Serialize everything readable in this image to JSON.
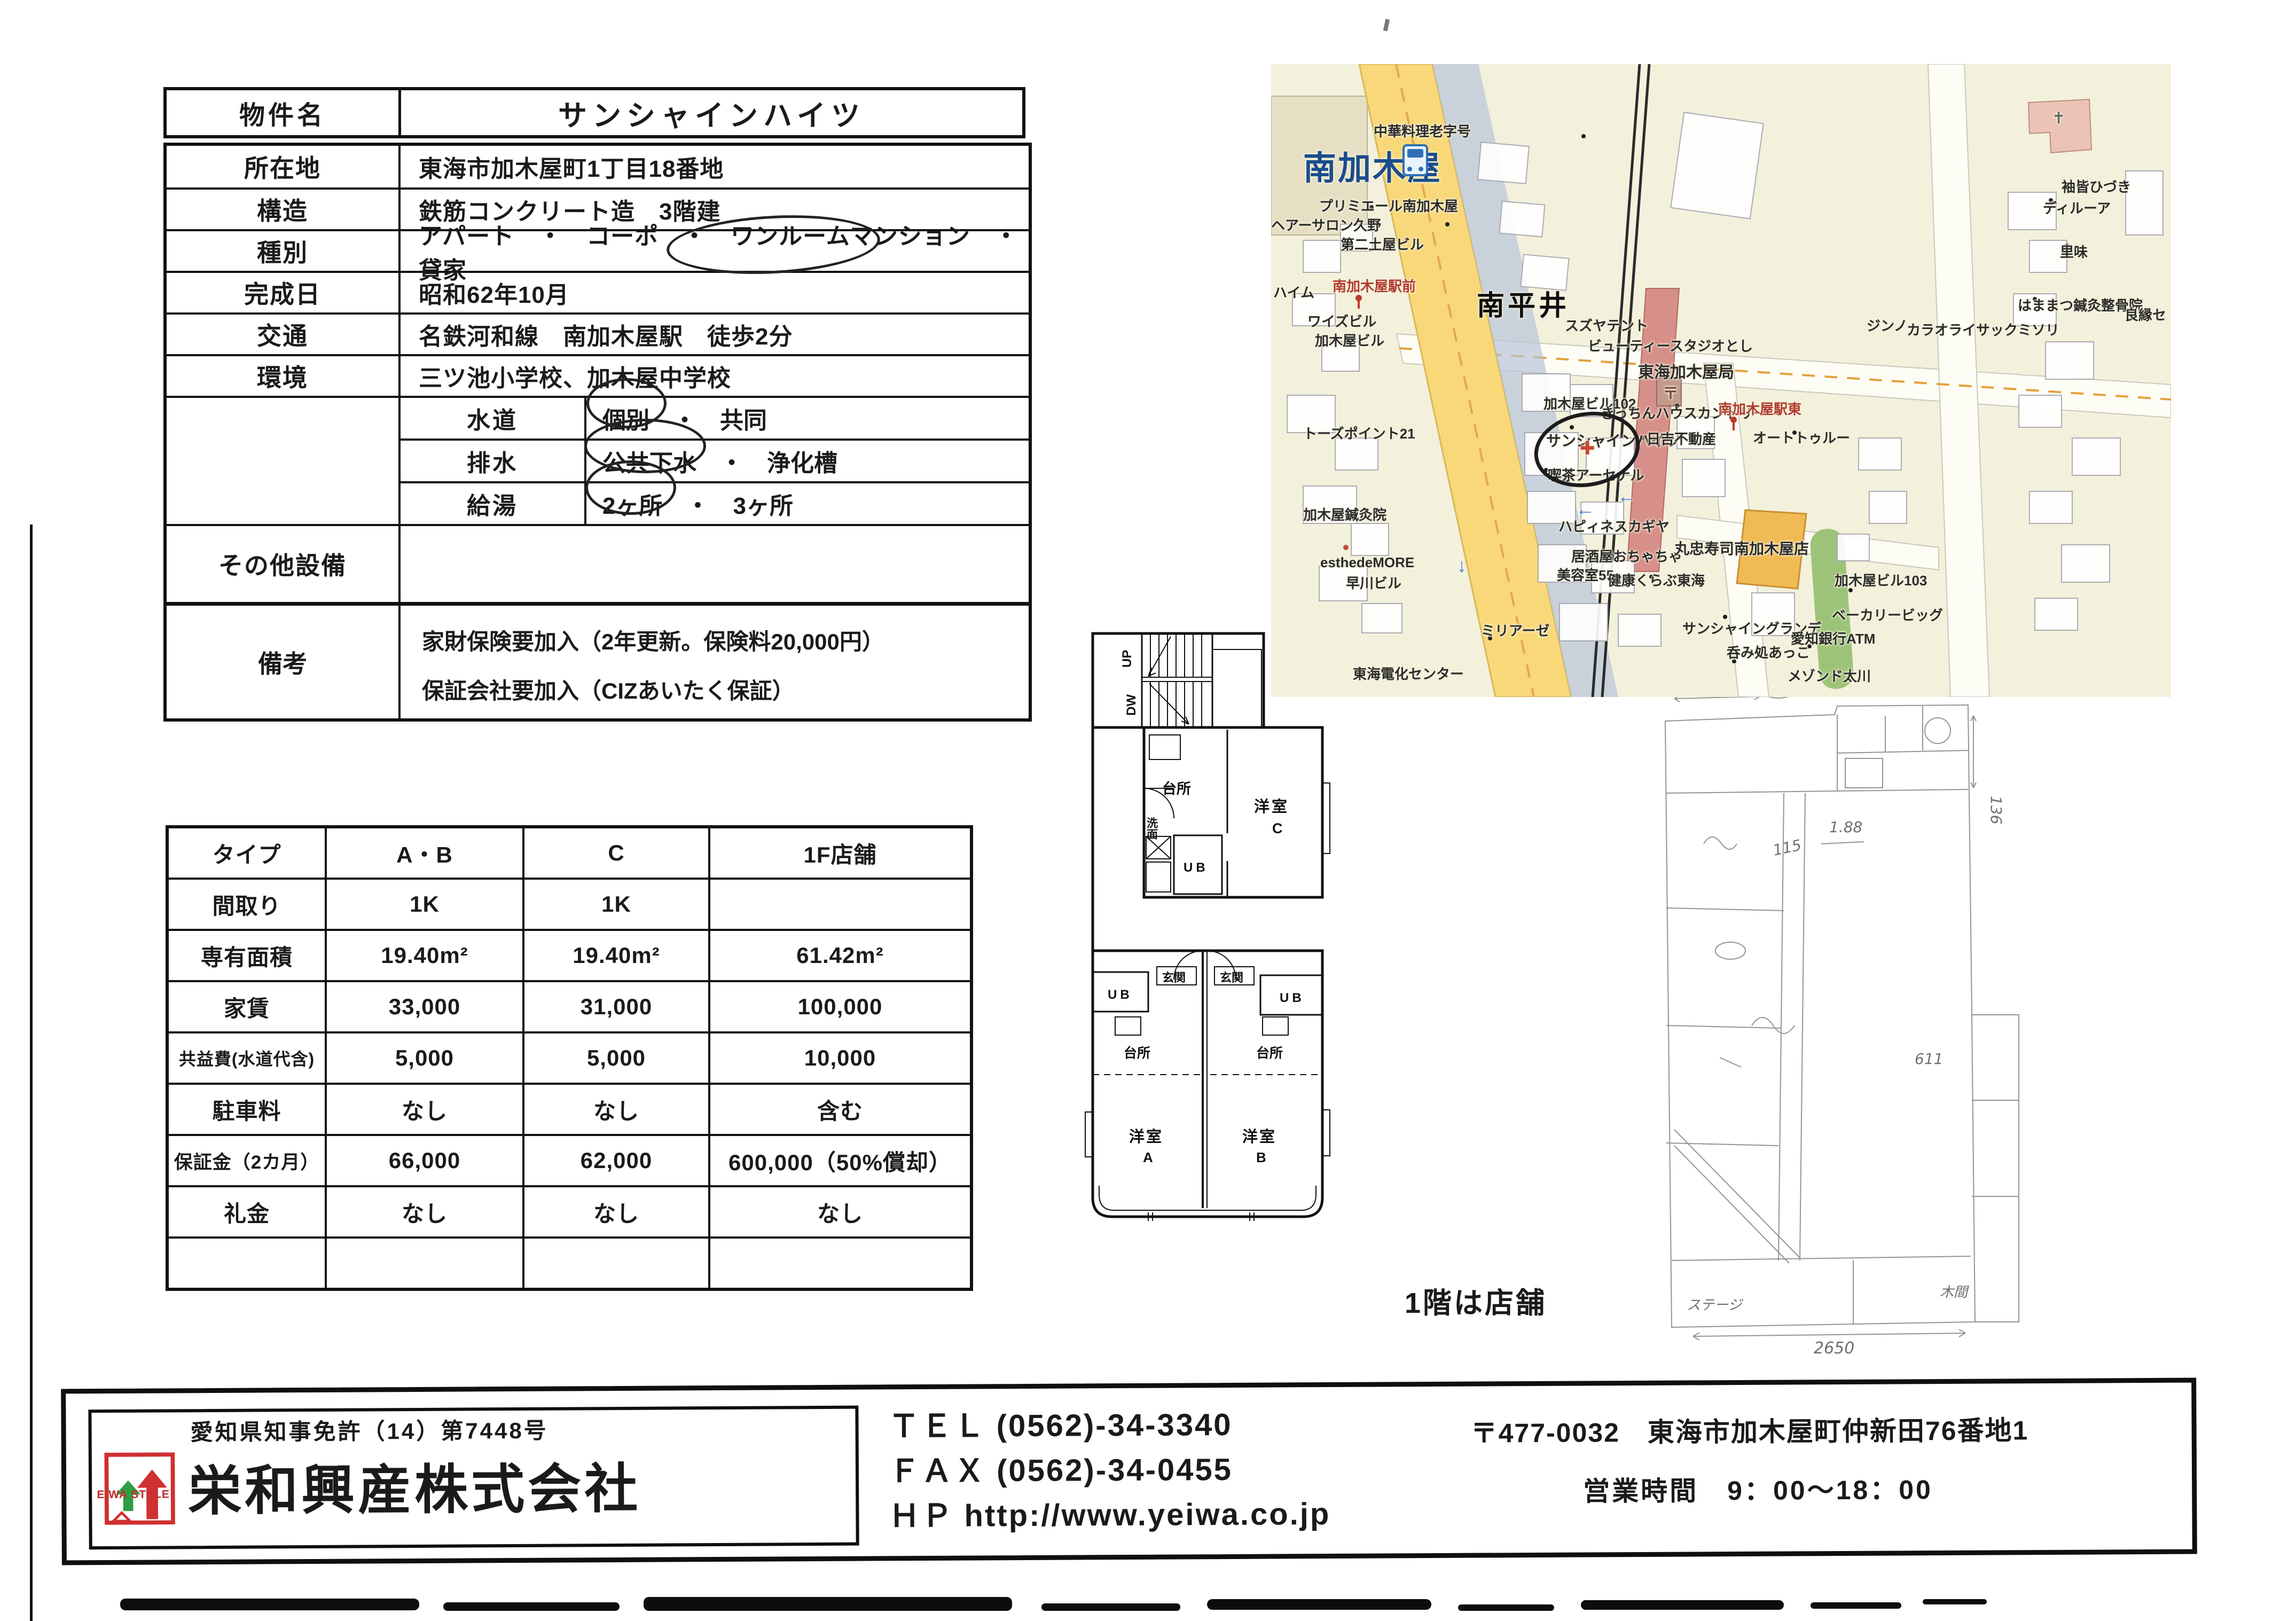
{
  "property": {
    "title_label": "物件名",
    "title": "サンシャインハイツ",
    "rows": [
      {
        "label": "所在地",
        "value": "東海市加木屋町1丁目18番地"
      },
      {
        "label": "構造",
        "value": "鉄筋コンクリート造　3階建"
      },
      {
        "label": "種別",
        "value": "アパート　・　コーポ　・　ワンルームマンション　・　貸家"
      },
      {
        "label": "完成日",
        "value": "昭和62年10月"
      },
      {
        "label": "交通",
        "value": "名鉄河和線　南加木屋駅　徒歩2分"
      },
      {
        "label": "環境",
        "value": "三ツ池小学校、加木屋中学校"
      }
    ],
    "utilities": [
      {
        "label": "水道",
        "value": "個別　・　共同"
      },
      {
        "label": "排水",
        "value": "公共下水　・　浄化槽"
      },
      {
        "label": "給湯",
        "value": "2ヶ所　・　3ヶ所"
      }
    ],
    "other_label": "その他設備",
    "remarks_label": "備考",
    "remarks": [
      "家財保険要加入（2年更新。保険料20,000円）",
      "保証会社要加入（CIZあいたく保証）"
    ]
  },
  "price": {
    "headers": [
      "タイプ",
      "A・B",
      "C",
      "1F店舗"
    ],
    "rows": [
      {
        "label": "間取り",
        "ab": "1K",
        "c": "1K",
        "shop": ""
      },
      {
        "label": "専有面積",
        "ab": "19.40m²",
        "c": "19.40m²",
        "shop": "61.42m²"
      },
      {
        "label": "家賃",
        "ab": "33,000",
        "c": "31,000",
        "shop": "100,000"
      },
      {
        "label": "共益費(水道代含)",
        "ab": "5,000",
        "c": "5,000",
        "shop": "10,000"
      },
      {
        "label": "駐車料",
        "ab": "なし",
        "c": "なし",
        "shop": "含む"
      },
      {
        "label": "保証金（2カ月）",
        "ab": "66,000",
        "c": "62,000",
        "shop": "600,000（50%償却）"
      },
      {
        "label": "礼金",
        "ab": "なし",
        "c": "なし",
        "shop": "なし"
      }
    ]
  },
  "floor_plan": {
    "up": "UP",
    "down": "DW",
    "kitchen": "台所",
    "washroom": "洗面",
    "ub": "UB",
    "room": "洋室",
    "unit_a": "A",
    "unit_b": "B",
    "unit_c": "C",
    "entrance": "玄関",
    "note": "1階は店舗"
  },
  "sketch": {
    "dims": [
      "180",
      "1.88",
      "115",
      "136",
      "611",
      "2650"
    ],
    "labels": [
      "ステージ",
      "木間"
    ]
  },
  "map": {
    "labels": [
      "中華料理老字号",
      "南加木屋",
      "南平井",
      "プリミエール南加木屋",
      "ヘアーサロン久野",
      "第二土屋ビル",
      "南加木屋駅前",
      "ワイズビル",
      "加木屋ビル",
      "ハイム",
      "トーズポイント21",
      "加木屋鍼灸院",
      "esthedeMORE",
      "早川ビル",
      "東海電化センター",
      "ビューティースタジオとし",
      "東海加木屋局",
      "加木屋ビル102",
      "きっちんハウスカントリー",
      "南加木屋駅東",
      "オートトゥルー",
      "サンシャインハイツ",
      "日吉不動産",
      "喫茶アーセナル",
      "ハピィネスカギヤ",
      "居酒屋おちゃちゃ",
      "美容室55",
      "健康くらぶ東海",
      "丸忠寿司南加木屋店",
      "サンシャイングランデ",
      "ミリアーゼ",
      "呑み処あっこ",
      "愛知銀行ATM",
      "加木屋ビル103",
      "ベーカリービッグ",
      "メゾンド太川",
      "スズヤテント",
      "ジンノ",
      "カラオライサックミソリ",
      "袖皆ひづき",
      "ディルーア",
      "里味",
      "はままつ鍼灸整骨院",
      "良縁セ"
    ],
    "icons": {
      "postal": "〒",
      "cross": "✚",
      "church": "✝",
      "arrow_left": "←",
      "arrow_down": "↓"
    }
  },
  "footer": {
    "license": "愛知県知事免許（14）第7448号",
    "company": "栄和興産株式会社",
    "logo_text": "EIWA STYLE",
    "tel": "ＴＥＬ (0562)-34-3340",
    "fax": "ＦＡＸ (0562)-34-0455",
    "hp": "ＨＰ http://www.yeiwa.co.jp",
    "postal": "〒477-0032　東海市加木屋町仲新田76番地1",
    "hours": "営業時間　9：00～18：00"
  }
}
